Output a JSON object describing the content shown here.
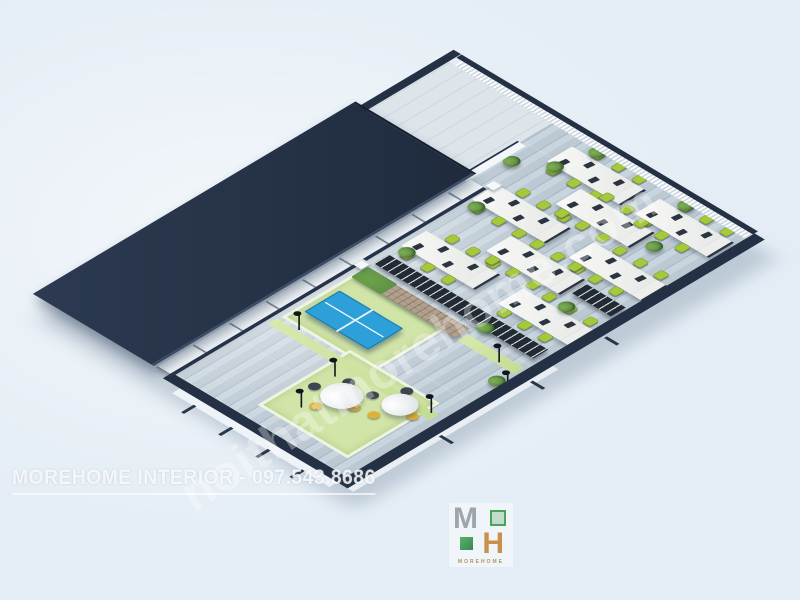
{
  "scene": {
    "description": "3D isometric architectural render of an open-plan office: dark navy shell, roofed left wing, wood-look floor, white bench desks with lime office chairs, black shelving racks, brick pallet wall, blue ping-pong table and lounge area with round tables",
    "colors": {
      "bg": "#e4edf5",
      "navy": "#243144",
      "floorA": "#c9d5de",
      "floorB": "#a9bac7",
      "floorB2": "#bcc9d3",
      "chairGreen": "#a5c83d",
      "chairGreenDark": "#7f9f2a",
      "rugGreen": "#d2e5a8",
      "hedgeGreen": "#5c8f45",
      "ttBlue": "#2d9fd9",
      "brick": "#b2a08e",
      "chairYellow": "#ddb13e",
      "chairDark": "#3d4550",
      "plantGreen": "#4f7f3a"
    },
    "furniture": {
      "desk_clusters": [
        {
          "x": 388,
          "y": 228
        },
        {
          "x": 518,
          "y": 222
        },
        {
          "x": 640,
          "y": 232
        },
        {
          "x": 455,
          "y": 310
        },
        {
          "x": 585,
          "y": 302
        },
        {
          "x": 388,
          "y": 398
        },
        {
          "x": 518,
          "y": 392
        },
        {
          "x": 640,
          "y": 386
        }
      ],
      "racks": [
        {
          "type": "brick",
          "x": 300,
          "y": 230,
          "w": 26,
          "h": 180
        },
        {
          "type": "rack",
          "x": 338,
          "y": 230,
          "w": 26,
          "h": 180
        },
        {
          "type": "rack",
          "x": 338,
          "y": 398,
          "w": 26,
          "h": 112
        },
        {
          "type": "rack",
          "x": 468,
          "y": 446,
          "w": 26,
          "h": 70
        }
      ],
      "rugs": [
        {
          "type": "rug",
          "x": 178,
          "y": 228,
          "w": 118,
          "h": 152
        },
        {
          "type": "rug",
          "x": 28,
          "y": 336,
          "w": 152,
          "h": 148
        },
        {
          "type": "runner",
          "x": 156,
          "y": 226,
          "w": 16,
          "h": 284
        },
        {
          "type": "runner",
          "x": 298,
          "y": 416,
          "w": 18,
          "h": 100
        }
      ],
      "pingpong": {
        "x": 206,
        "y": 240,
        "w": 58,
        "h": 108
      },
      "round_tables": [
        {
          "x": 88,
          "y": 370,
          "r": 27
        },
        {
          "x": 130,
          "y": 438,
          "r": 23
        }
      ],
      "plants": [
        {
          "x": 372,
          "y": 232
        },
        {
          "x": 500,
          "y": 226
        },
        {
          "x": 628,
          "y": 236
        },
        {
          "x": 686,
          "y": 252
        },
        {
          "x": 330,
          "y": 412
        },
        {
          "x": 432,
          "y": 452
        },
        {
          "x": 598,
          "y": 440
        },
        {
          "x": 686,
          "y": 408
        },
        {
          "x": 262,
          "y": 500
        },
        {
          "x": 598,
          "y": 190
        }
      ],
      "lamps": [
        {
          "x": 192,
          "y": 232
        },
        {
          "x": 155,
          "y": 332
        },
        {
          "x": 80,
          "y": 348
        },
        {
          "x": 186,
          "y": 470
        },
        {
          "x": 320,
          "y": 455
        },
        {
          "x": 288,
          "y": 502
        }
      ],
      "pillars": [
        {
          "x": 318,
          "y": 214
        },
        {
          "x": 550,
          "y": 214
        }
      ]
    }
  },
  "watermarks": {
    "bottom_left": "MOREHOME INTERIOR - 097.543.8686",
    "diagonal": "noithatmorehome.com"
  },
  "logo": {
    "m": "M",
    "h": "H",
    "subtext": "MOREHOME"
  }
}
